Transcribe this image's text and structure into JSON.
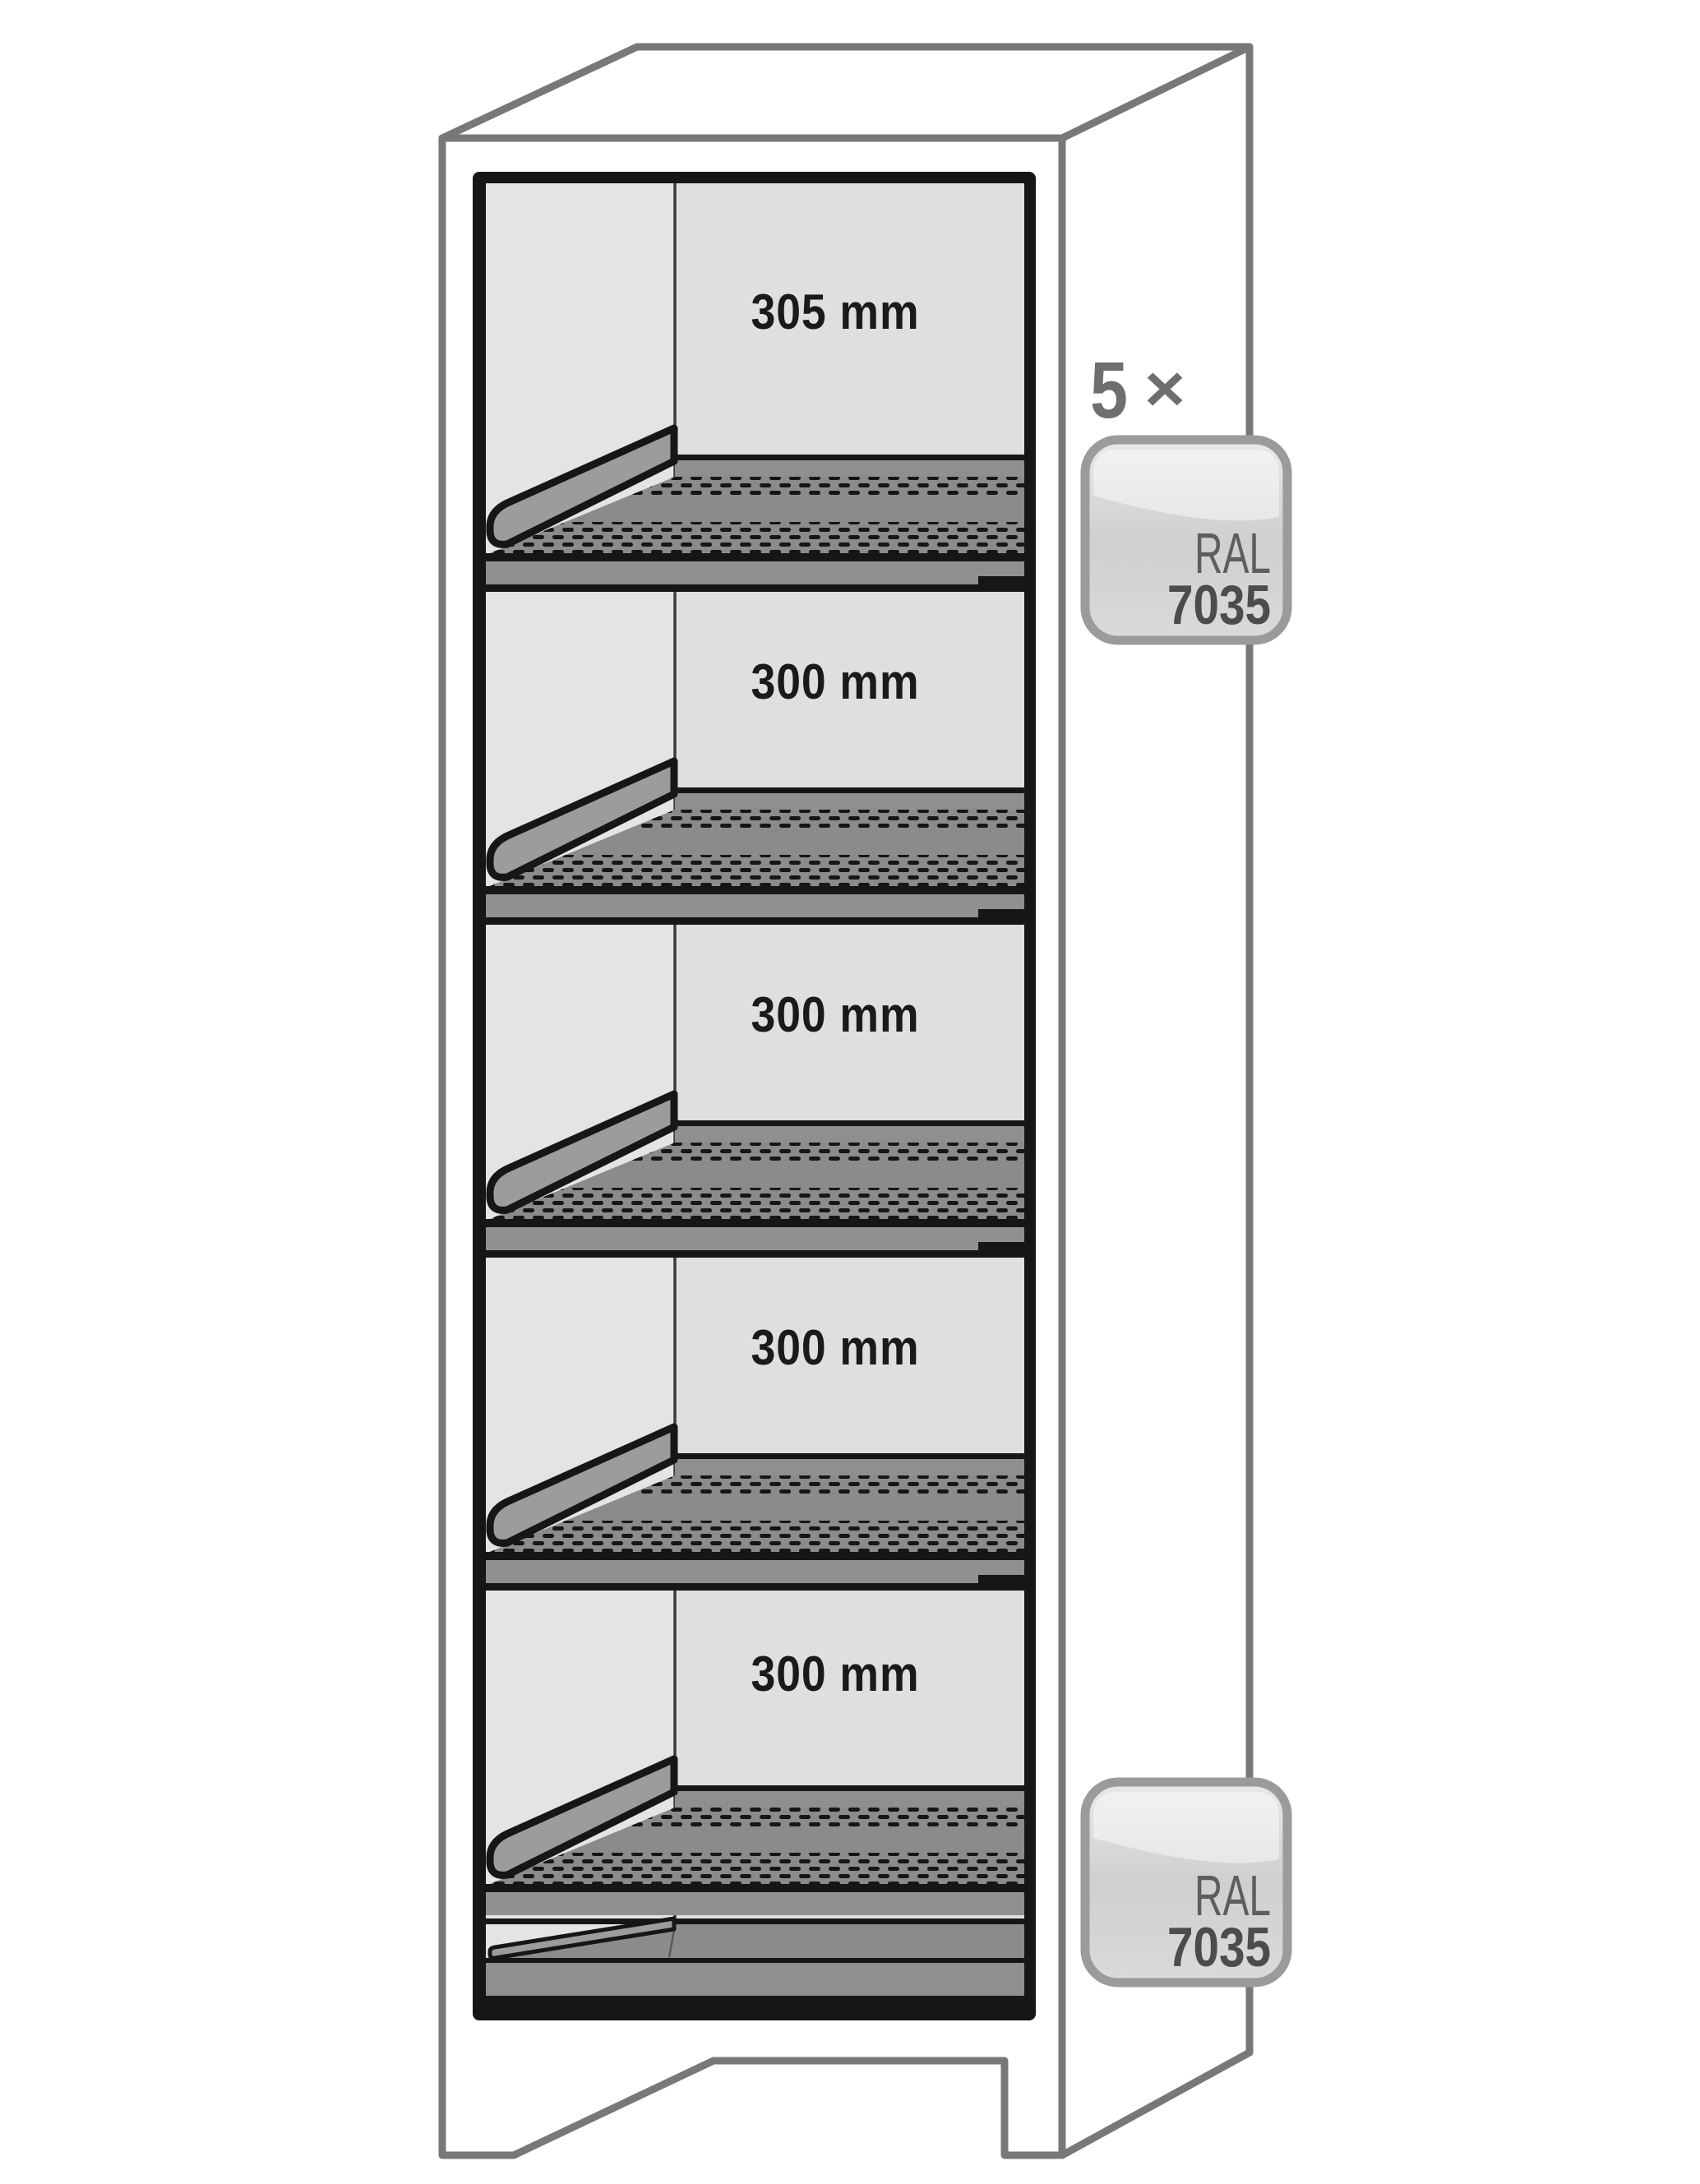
{
  "diagram": {
    "type": "safety-cabinet-interior-shelf-diagram",
    "compartments": [
      {
        "label": "305 mm"
      },
      {
        "label": "300 mm"
      },
      {
        "label": "300 mm"
      },
      {
        "label": "300 mm"
      },
      {
        "label": "300 mm"
      }
    ],
    "shelf_quantity": {
      "count": "5",
      "times_symbol": "×"
    },
    "color_badges": [
      {
        "system": "RAL",
        "code": "7035"
      },
      {
        "system": "RAL",
        "code": "7035"
      }
    ],
    "colors": {
      "outline_gray": "#787878",
      "frame_black": "#161616",
      "interior_left_wall": "#e4e4e4",
      "interior_back_wall": "#dfdfdf",
      "shelf_gray": "#8b8b8b",
      "shelf_riser_gray": "#8f8f8f",
      "shelf_lip_gray": "#9c9c9c",
      "label_text": "#1a1a1a",
      "quantity_text": "#6e6e6e",
      "badge_border": "#9b9b9b",
      "badge_system_text": "#5e5e5e",
      "badge_code_text": "#4c4c4c"
    }
  }
}
